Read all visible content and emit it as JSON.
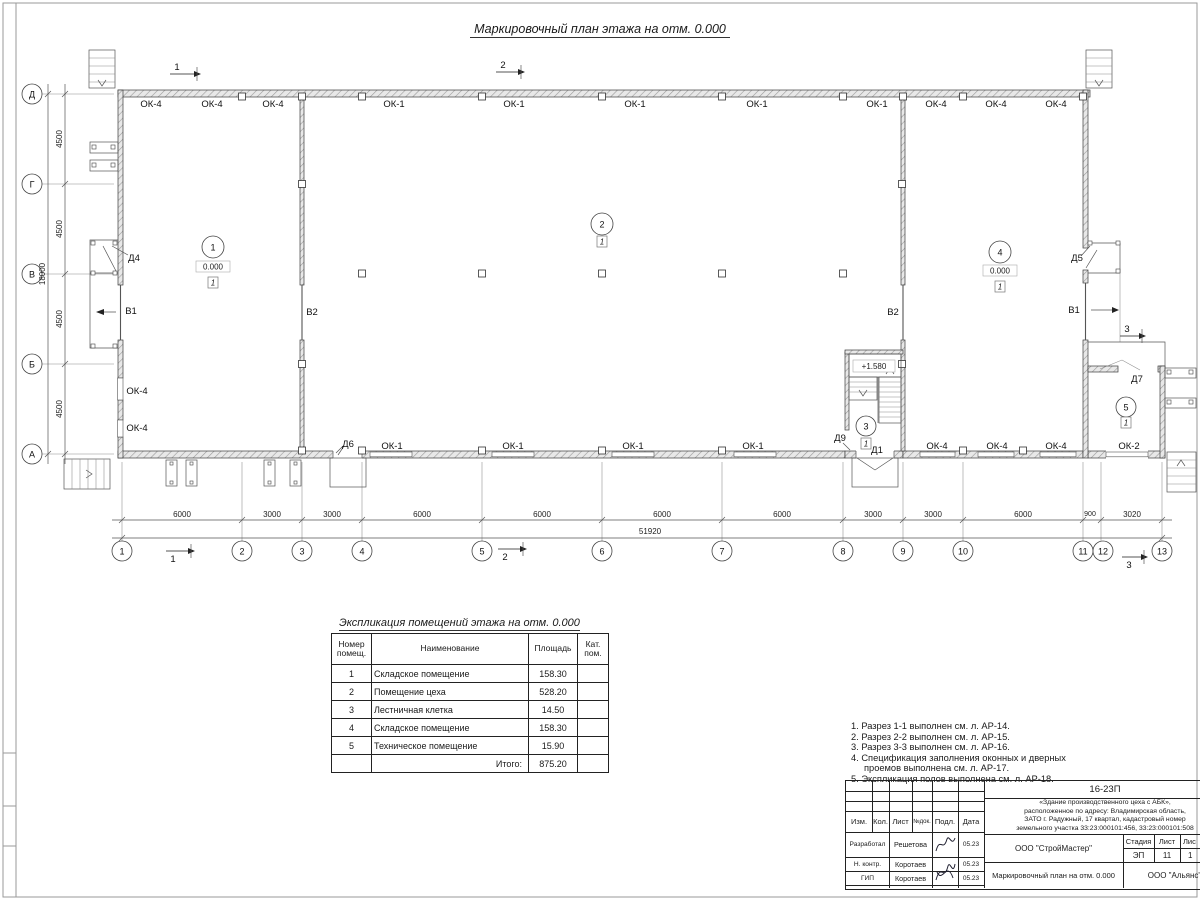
{
  "colors": {
    "paper": "#ffffff",
    "ink": "#2b2b2b",
    "hatch_fill": "#e8e8e8",
    "hatch_line": "#9a9a9a"
  },
  "plan_title": "Маркировочный план этажа на отм. 0.000",
  "plan": {
    "axes_bottom": [
      "1",
      "2",
      "3",
      "4",
      "5",
      "6",
      "7",
      "8",
      "9",
      "10",
      "11",
      "12",
      "13"
    ],
    "axes_left": [
      "Д",
      "Г",
      "В",
      "Б",
      "А"
    ],
    "dims_bottom": [
      "6000",
      "3000",
      "3000",
      "6000",
      "6000",
      "6000",
      "6000",
      "3000",
      "3000",
      "6000",
      "900",
      "3020"
    ],
    "dim_total_bottom": "51920",
    "dims_left": [
      "4500",
      "4500",
      "4500",
      "4500"
    ],
    "dim_total_left": "18000",
    "win_top": [
      "ОК-4",
      "ОК-4",
      "ОК-4",
      "ОК-1",
      "ОК-1",
      "ОК-1",
      "ОК-1",
      "ОК-1",
      "ОК-4",
      "ОК-4",
      "ОК-4"
    ],
    "win_bottom": [
      "ОК-1",
      "ОК-1",
      "ОК-1",
      "ОК-1",
      "ОК-4",
      "ОК-4",
      "ОК-4",
      "ОК-2"
    ],
    "win_left": [
      "ОК-4",
      "ОК-4"
    ],
    "doors": {
      "d4": "Д4",
      "d5": "Д5",
      "d6": "Д6",
      "d7": "Д7",
      "d9": "Д9",
      "d1": "Д1"
    },
    "gates": {
      "v1": "В1",
      "v2": "В2"
    },
    "rooms": {
      "r1": {
        "num": "1",
        "level": "0.000",
        "floor": "1"
      },
      "r2": {
        "num": "2",
        "floor": "1"
      },
      "r3": {
        "num": "3",
        "floor": "1"
      },
      "r4": {
        "num": "4",
        "level": "0.000",
        "floor": "1"
      },
      "r5": {
        "num": "5",
        "floor": "1"
      }
    },
    "stair_level": "+1.580",
    "sections": {
      "s1": "1",
      "s2": "2",
      "s3": "3"
    }
  },
  "table": {
    "title": "Экспликация помещений этажа на отм. 0.000",
    "headers": {
      "num": "Номер помещ.",
      "name": "Наименование",
      "area": "Площадь",
      "cat": "Кат. пом."
    },
    "rows": [
      {
        "num": "1",
        "name": "Складское помещение",
        "area": "158.30"
      },
      {
        "num": "2",
        "name": "Помещение цеха",
        "area": "528.20"
      },
      {
        "num": "3",
        "name": "Лестничная клетка",
        "area": "14.50"
      },
      {
        "num": "4",
        "name": "Складское помещение",
        "area": "158.30"
      },
      {
        "num": "5",
        "name": "Техническое помещение",
        "area": "15.90"
      }
    ],
    "total_label": "Итого:",
    "total_value": "875.20"
  },
  "notes": {
    "lines": [
      "1. Разрез 1-1 выполнен см. л. АР-14.",
      "2. Разрез 2-2 выполнен см. л. АР-15.",
      "3. Разрез 3-3 выполнен см. л. АР-16.",
      "4. Спецификация заполнения оконных и дверных",
      "проемов выполнена см. л. АР-17.",
      "5. Экспликация полов выполнена см. л. АР-18."
    ]
  },
  "titleblock": {
    "doc_number": "16-23П",
    "description": [
      "«Здание производственного цеха с АБК»,",
      "расположенное по адресу: Владимирская область,",
      "ЗАТО г. Радужный, 17 квартал, кадастровый номер",
      "земельного участка 33:23:000101:456, 33:23:000101:508"
    ],
    "cols": {
      "izm": "Изм.",
      "kol": "Кол.",
      "list": "Лист",
      "ndoc": "№док.",
      "podp": "Подл.",
      "data": "Дата"
    },
    "rows": [
      {
        "role": "Разработал",
        "name": "Решетова",
        "date": "05.23"
      },
      {
        "role": "Н. контр.",
        "name": "Коротаев",
        "date": "05.23"
      },
      {
        "role": "ГИП",
        "name": "Коротаев",
        "date": "05.23"
      }
    ],
    "org1": "ООО \"СтройМастер\"",
    "sheet_title": "Маркировочный план на отм. 0.000",
    "org2": "ООО \"Альянс\"",
    "stage": {
      "h1": "Стадия",
      "h2": "Лист",
      "h3": "Лис",
      "v1": "ЭП",
      "v2": "11",
      "v3": "1"
    }
  }
}
